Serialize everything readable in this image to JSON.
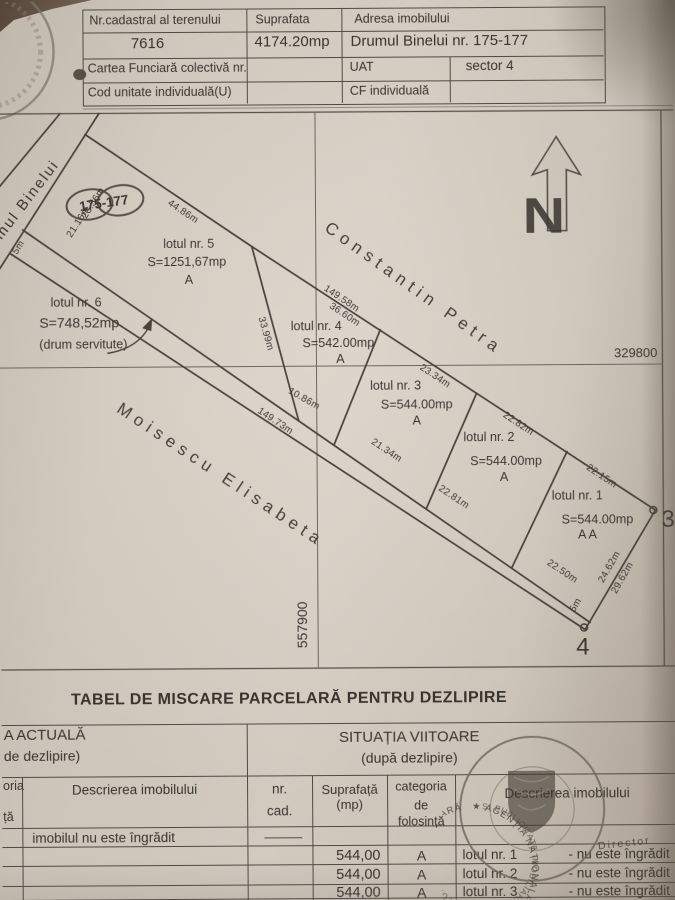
{
  "colors": {
    "paper": "#d1cabf",
    "paper_edge": "#ab9f92",
    "ink": "#38342f",
    "plot_line": "#4e4a44",
    "stamp_ink": "#6e665c",
    "desk": "#5f4f40"
  },
  "top_table": {
    "c1_header": "Nr.cadastral al terenului",
    "c2_header": "Suprafata",
    "c3_header": "Adresa imobilului",
    "nr_cadastral": "7616",
    "suprafata": "4174.20mp",
    "adresa": "Drumul Binelui nr. 175-177",
    "cartea_funciara": "Cartea Funciară colectivă nr.",
    "uat_label": "UAT",
    "uat_value": "sector 4",
    "cod_unitate": "Cod unitate individuală(U)",
    "cf_individuala": "CF individuală"
  },
  "plan": {
    "street": "Drumul Binelui",
    "street_numbers": "175-177",
    "neighbor_ne": "Constantin Petra",
    "neighbor_sw": "Moisescu  Elisabeta",
    "grid_x": "557900",
    "grid_y": "329800",
    "north_letter": "N",
    "point_3": "3",
    "point_4": "4",
    "lots": [
      {
        "name": "lotul nr. 5",
        "area": "S=1251,67mp",
        "cat": "A"
      },
      {
        "name": "lotul nr. 6",
        "area": "S=748,52mp",
        "cat": "(drum servitute)"
      },
      {
        "name": "lotul nr. 4",
        "area": "S=542.00mp",
        "cat": "A"
      },
      {
        "name": "lotul nr. 3",
        "area": "S=544.00mp",
        "cat": "A"
      },
      {
        "name": "lotul nr. 2",
        "area": "S=544.00mp",
        "cat": "A"
      },
      {
        "name": "lotul nr. 1",
        "area": "S=544.00mp",
        "cat": "A A"
      }
    ],
    "m": {
      "road_a": "28.56m",
      "road_b": "21.16m",
      "road_w": "5m",
      "lot5_ne": "44.86m",
      "ne_total": "149.58m",
      "lot4_ne": "36.60m",
      "d54": "33.99m",
      "lot4_sw": "10.86m",
      "lot3_ne": "23.34m",
      "sw_total": "149.73m",
      "lot3_sw": "21.34m",
      "lot2_ne": "22.82m",
      "lot2_sw": "22.81m",
      "lot1_ne": "22.15m",
      "lot1_sw": "22.50m",
      "e34_a": "24.62m",
      "e34_b": "29.62m",
      "end_w": "5m"
    }
  },
  "movement_table": {
    "title": "TABEL DE MISCARE PARCELARĂ PENTRU DEZLIPIRE",
    "left_frag_1": "A ACTUALĂ",
    "left_frag_2": "de dezlipire)",
    "right_line_1": "SITUAȚIA  VIITOARE",
    "right_line_2": "(după dezlipire)",
    "col_frag_a": "oria",
    "col_frag_b": "ță",
    "col_desc": "Descrierea imobilului",
    "col_nr": "nr.",
    "col_cad": "cad.",
    "col_supr": "Suprafață",
    "col_mp": "(mp)",
    "col_cat_1": "categoria",
    "col_cat_2": "de",
    "col_cat_3": "folosință",
    "col_desc2": "Descrierea imobilului",
    "note_row": "imobilul nu este îngrădit",
    "rows": [
      {
        "supr": "544,00",
        "cat": "A",
        "lot": "lotul nr. 1",
        "state": "- nu este îngrădit"
      },
      {
        "supr": "544,00",
        "cat": "A",
        "lot": "lotul nr. 2",
        "state": "- nu este îngrădit"
      },
      {
        "supr": "544,00",
        "cat": "A",
        "lot": "lotul nr. 3",
        "state": "- nu este îngrădit"
      }
    ],
    "stamp": {
      "ring": "★ AGENȚIA NAȚIONALĂ DE CADASTRU ȘI PUBLICITATE IMOBILIARĂ ",
      "ring2": "ȘI PUBLICITATE IMOBILIARĂ A MUN ★ BUCUREȘTI ★ AGEN",
      "director": "Director"
    }
  }
}
